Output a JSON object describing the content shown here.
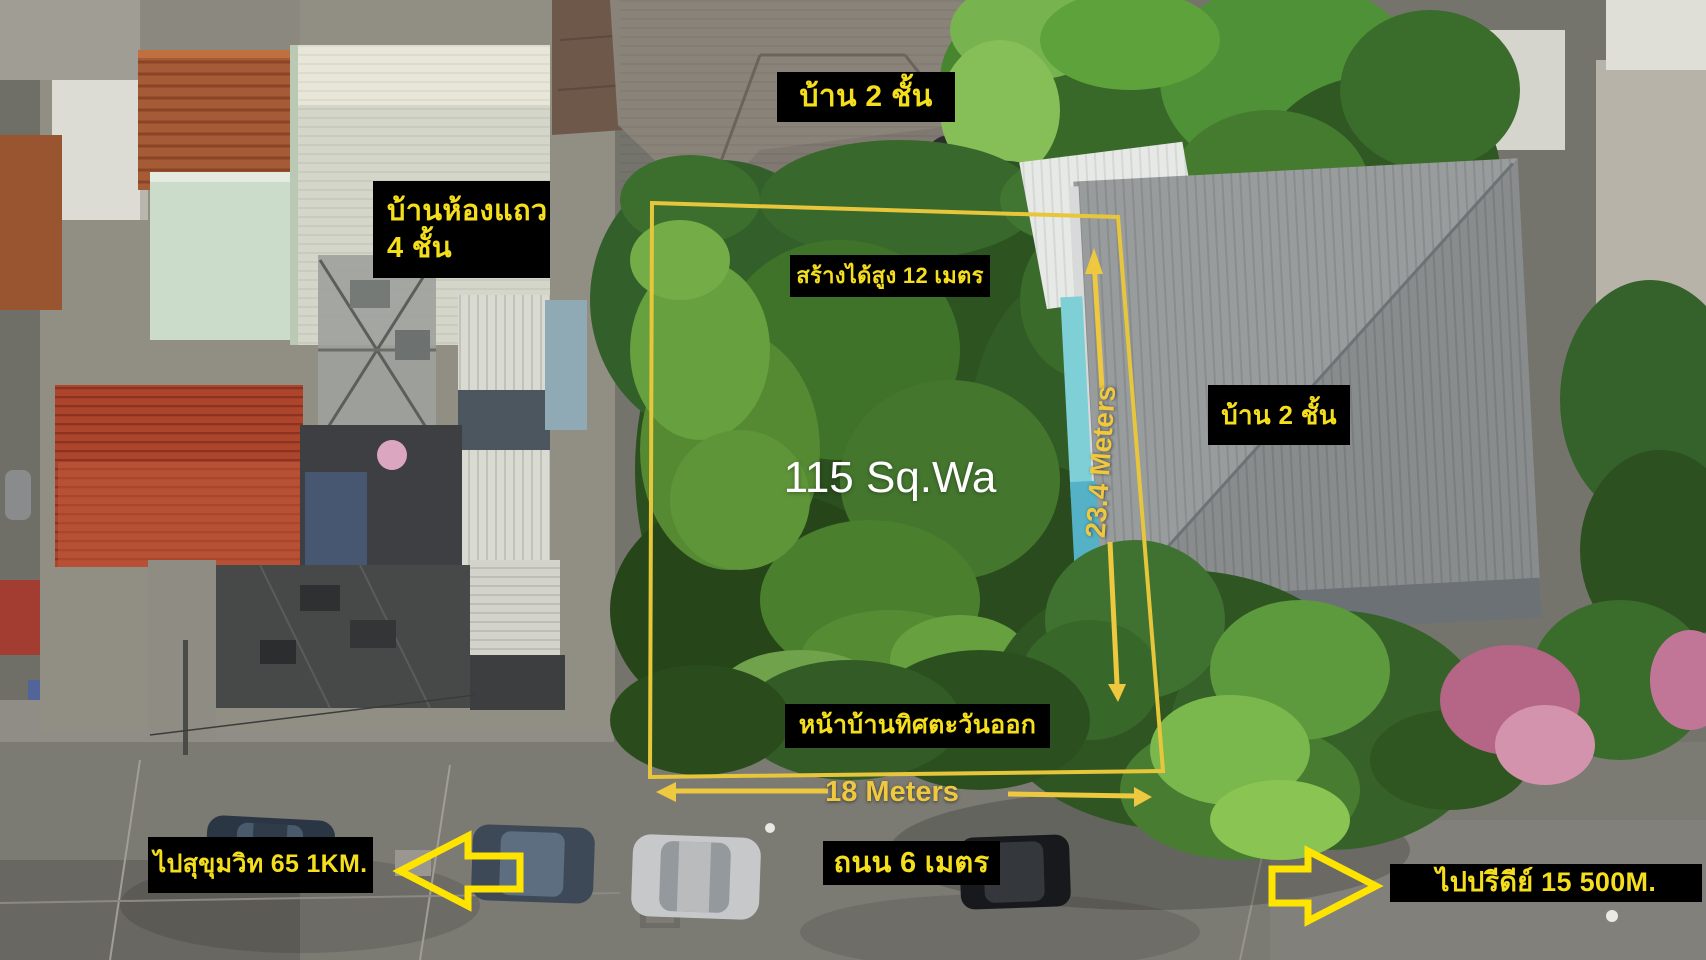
{
  "scene": "aerial land plot for sale with Thai annotations",
  "annotations": {
    "top_house": "บ้าน 2 ชั้น",
    "rowhouse_line1": "บ้านห้องแถว",
    "rowhouse_line2": "4 ชั้น",
    "build_height": "สร้างได้สูง 12 เมตร",
    "area": "115 Sq.Wa",
    "depth": "23.4 Meters",
    "width": "18 Meters",
    "right_house": "บ้าน 2 ชั้น",
    "frontage": "หน้าบ้านทิศตะวันออก",
    "road": "ถนน 6 เมตร",
    "to_sukhumvit": "ไปสุขุมวิท 65 1KM.",
    "to_pridi": "ไปปรีดีย์ 15 500M."
  },
  "colors": {
    "annotation_yellow": "#ffe400",
    "label_text_yellow": "#f5df1c",
    "dimension_gold": "#eec83f",
    "plot_outline_gold": "#e8c63c",
    "label_background": "#000000",
    "area_text_white": "#ffffff"
  }
}
